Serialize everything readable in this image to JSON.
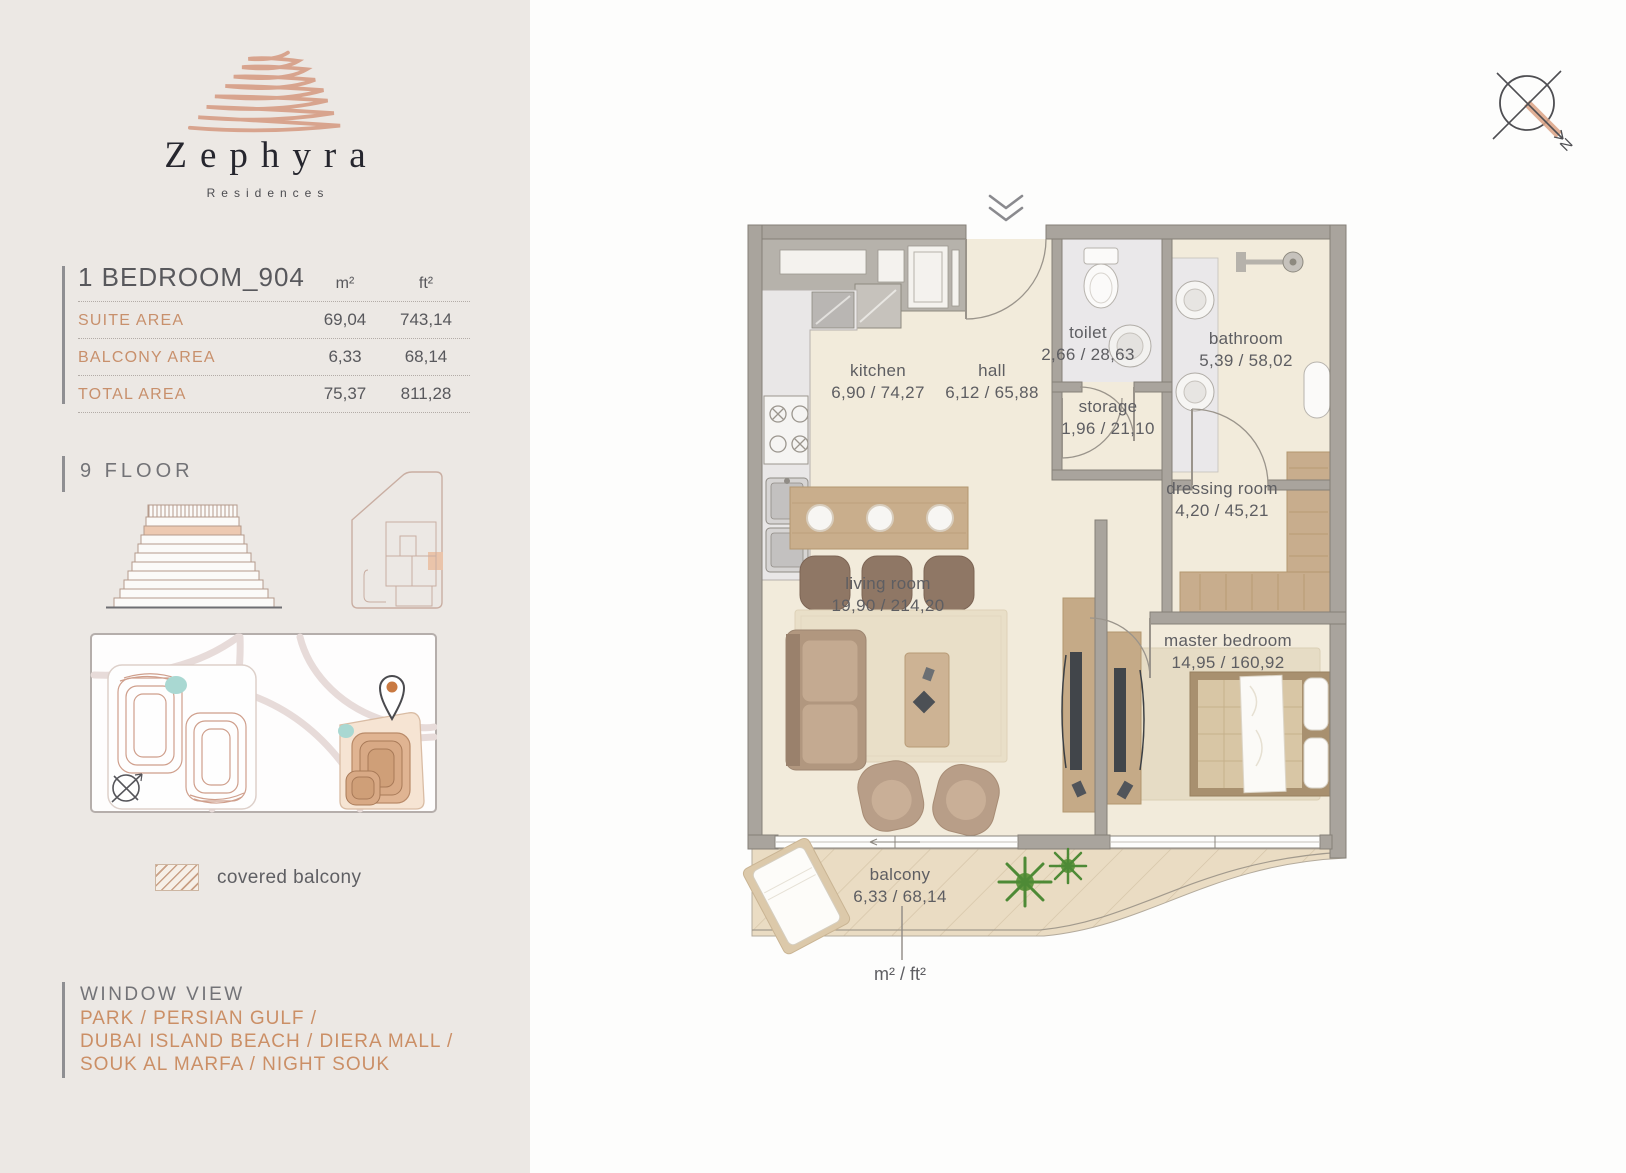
{
  "brand": {
    "name": "Zephyra",
    "subtitle": "Residences"
  },
  "unit": {
    "title": "1 BEDROOM_904",
    "columns": {
      "m2": "m²",
      "ft2": "ft²"
    },
    "rows": [
      {
        "label": "SUITE AREA",
        "m2": "69,04",
        "ft2": "743,14"
      },
      {
        "label": "BALCONY AREA",
        "m2": "6,33",
        "ft2": "68,14"
      },
      {
        "label": "TOTAL AREA",
        "m2": "75,37",
        "ft2": "811,28"
      }
    ]
  },
  "floor": {
    "label": "9 FLOOR"
  },
  "legend": {
    "covered_balcony": "covered balcony"
  },
  "window_view": {
    "title": "WINDOW VIEW",
    "lines": [
      "PARK / PERSIAN GULF /",
      "DUBAI ISLAND BEACH / DIERA MALL /",
      "SOUK AL MARFA / NIGHT SOUK"
    ]
  },
  "plan": {
    "rooms": [
      {
        "name": "kitchen",
        "area": "6,90 / 74,27"
      },
      {
        "name": "hall",
        "area": "6,12 / 65,88"
      },
      {
        "name": "toilet",
        "area": "2,66 / 28,63"
      },
      {
        "name": "bathroom",
        "area": "5,39 / 58,02"
      },
      {
        "name": "storage",
        "area": "1,96 / 21,10"
      },
      {
        "name": "dressing room",
        "area": "4,20 / 45,21"
      },
      {
        "name": "living room",
        "area": "19,90 / 214,20"
      },
      {
        "name": "master bedroom",
        "area": "14,95 / 160,92"
      },
      {
        "name": "balcony",
        "area": "6,33 / 68,14"
      }
    ],
    "units_note": "m² / ft²",
    "north_label": "N"
  },
  "icons": {
    "entrance": "chevron-down",
    "north": "compass",
    "location": "map-pin"
  },
  "colors": {
    "accent_tan": "#c8906c",
    "text_gray": "#5e5e62",
    "wall_gray": "#a9a49d",
    "floor_cream": "#f2ebdb",
    "sidebar_bg": "#ece8e4",
    "logo_rose": "#d8a48e",
    "highlight_tan": "#edc9b1"
  }
}
